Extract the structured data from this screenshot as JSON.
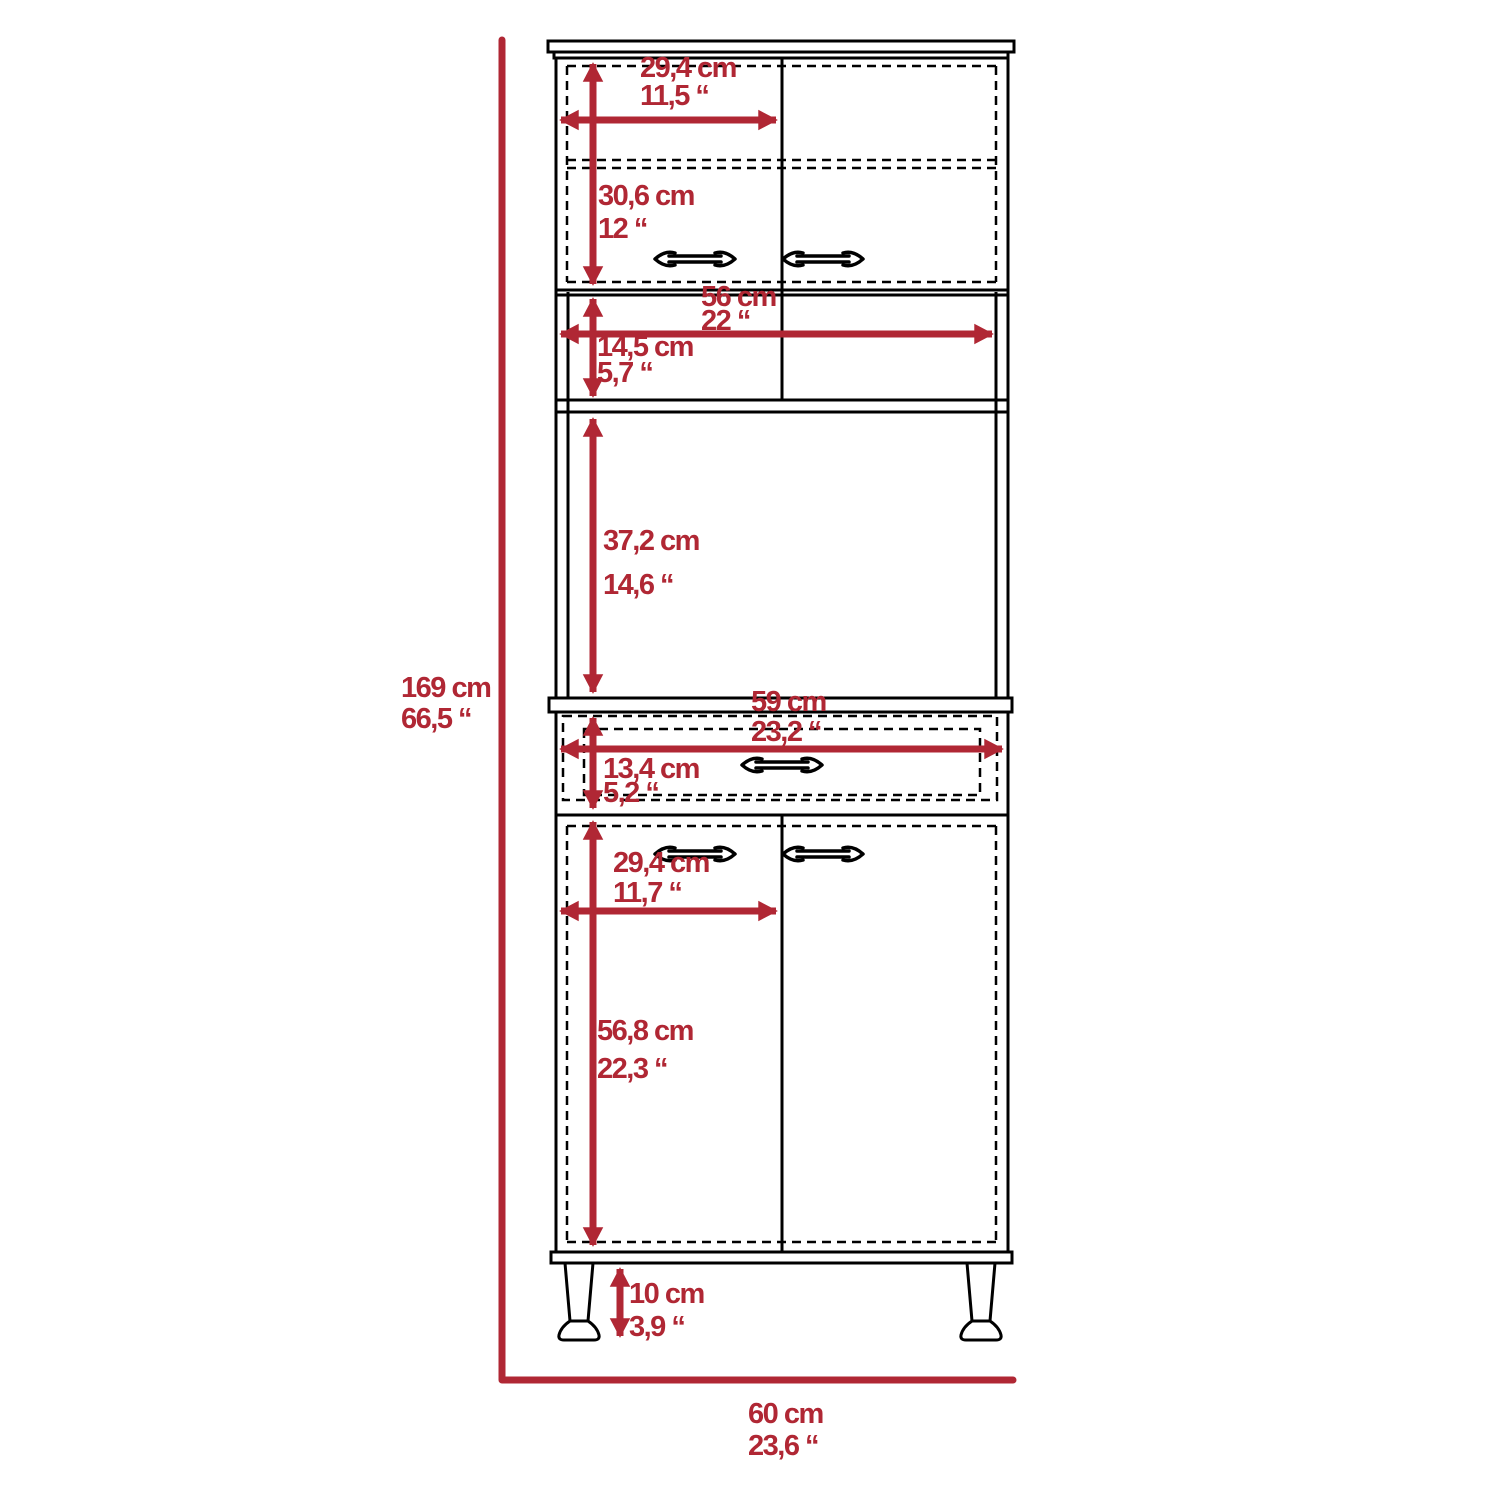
{
  "diagram": {
    "title": "pantry-cabinet-dimension-drawing",
    "accent_color": "#b02734",
    "line_color": "#000000",
    "dims": {
      "overall_height": {
        "cm": "169 cm",
        "in": "66,5 “"
      },
      "overall_width": {
        "cm": "60 cm",
        "in": "23,6 “"
      },
      "upper_door_width": {
        "cm": "29,4 cm",
        "in": "11,5 “"
      },
      "upper_door_height": {
        "cm": "30,6 cm",
        "in": "12 “"
      },
      "shelf_width": {
        "cm": "56 cm",
        "in": "22 “"
      },
      "shelf_height": {
        "cm": "14,5 cm",
        "in": "5,7 “"
      },
      "open_space_height": {
        "cm": "37,2 cm",
        "in": "14,6 “"
      },
      "drawer_width": {
        "cm": "59 cm",
        "in": "23,2 “"
      },
      "drawer_height": {
        "cm": "13,4 cm",
        "in": "5,2 “"
      },
      "lower_door_width": {
        "cm": "29,4 cm",
        "in": "11,7 “"
      },
      "lower_door_height": {
        "cm": "56,8 cm",
        "in": "22,3 “"
      },
      "leg_height": {
        "cm": "10 cm",
        "in": "3,9 “"
      }
    }
  }
}
